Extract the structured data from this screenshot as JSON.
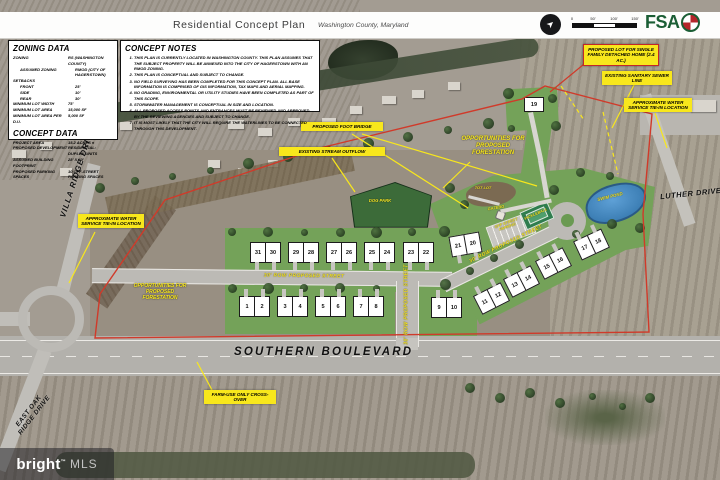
{
  "header": {
    "title": "Residential Concept Plan",
    "subtitle": "Washington County, Maryland",
    "logo_text": "FSA",
    "scale_ticks": [
      "0",
      "50'",
      "100'",
      "150'"
    ],
    "north_arrow_icon": "compass-north-arrow"
  },
  "panels": {
    "zoning": {
      "title": "ZONING DATA",
      "rows": [
        {
          "label": "ZONING",
          "value": "RS (WASHINGTON COUNTY)",
          "indent": 0
        },
        {
          "label": "ASSUMED ZONING",
          "value": "RMOD (CITY OF HAGERSTOWN)",
          "indent": 1
        },
        {
          "label": "SETBACKS",
          "value": "",
          "indent": 0
        },
        {
          "label": "FRONT",
          "value": "25'",
          "indent": 1
        },
        {
          "label": "SIDE",
          "value": "10'",
          "indent": 1
        },
        {
          "label": "REAR",
          "value": "30'",
          "indent": 1
        },
        {
          "label": "MINIMUM LOT WIDTH",
          "value": "75'",
          "indent": 0
        },
        {
          "label": "MINIMUM LOT AREA",
          "value": "15,000 SF",
          "indent": 0
        },
        {
          "label": "MINIMUM LOT AREA PER D.U.",
          "value": "5,000 SF",
          "indent": 0
        }
      ]
    },
    "concept": {
      "title": "CONCEPT DATA",
      "rows": [
        {
          "label": "PROJECT AREA",
          "value": "15.2 ACRES ±",
          "indent": 0
        },
        {
          "label": "PROPOSED DEVELOPMENT",
          "value": "RESIDENTIAL: DUPLEX UNITS",
          "indent": 0
        },
        {
          "label": "ASSUMED BUILDING FOOTPRINT",
          "value": "28' X 40'",
          "indent": 0
        },
        {
          "label": "PROPOSED PARKING SPACES",
          "value": "10 OFF-STREET PARKING SPACES",
          "indent": 0
        }
      ]
    },
    "notes": {
      "title": "CONCEPT NOTES",
      "items": [
        "THIS PLAN IS CURRENTLY LOCATED IN WASHINGTON COUNTY. THIS PLAN ASSUMES THAT THE SUBJECT PROPERTY WILL BE ANNEXED INTO THE CITY OF HAGERSTOWN WITH AN RMOD ZONING.",
        "THIS PLAN IS CONCEPTUAL AND SUBJECT TO CHANGE.",
        "NO FIELD SURVEYING HAS BEEN COMPLETED FOR THIS CONCEPT PLAN. ALL BASE INFORMATION IS COMPRISED OF GIS INFORMATION, TAX MAPS AND AERIAL MAPPING.",
        "NO GRADING, ENVIRONMENTAL OR UTILITY STUDIES HAVE BEEN COMPLETED AS PART OF THIS SCOPE.",
        "STORMWATER MANAGEMENT IS CONCEPTUAL IN SIZE AND LOCATION.",
        "ALL PROPOSED ACCESS POINTS AND ENTRANCES MUST BE REVIEWED AND APPROVED BY THE REVIEWING AGENCIES AND SUBJECT TO CHANGE.",
        "IT IS MOST LIKELY THAT THE CITY WILL REQUIRE THE WATERLINES TO BE CONNECTED THROUGH THIS DEVELOPMENT."
      ]
    }
  },
  "callouts": [
    {
      "text": "PROPOSED FOOT BRIDGE",
      "style": "box"
    },
    {
      "text": "EXISTING STREAM OUTFLOW",
      "style": "box"
    },
    {
      "text": "OPPORTUNITIES FOR PROPOSED FORESTATION",
      "style": "text"
    },
    {
      "text": "PROPOSED LOT FOR SINGLE FAMILY DETACHED HOME (2.4 AC.)",
      "style": "box-red"
    },
    {
      "text": "EXISTING SANITARY SEWER LINE",
      "style": "box"
    },
    {
      "text": "APPROXIMATE WATER SERVICE TIE-IN LOCATION",
      "style": "box"
    },
    {
      "text": "APPROXIMATE WATER SERVICE TIE-IN LOCATION",
      "style": "box"
    },
    {
      "text": "OPPORTUNITIES FOR PROPOSED FORESTATION",
      "style": "text"
    },
    {
      "text": "FARM-USE ONLY CROSS-OVER",
      "style": "box"
    }
  ],
  "amenity_labels": [
    "DOG PARK",
    "TOT LOT",
    "GAZEBO",
    "PICKLEBALL",
    "OFF STREET PARKING",
    "SWIM POND"
  ],
  "street_label": "30' ROW PROPOSED STREET",
  "road_labels": [
    "SOUTHERN BOULEVARD",
    "VILLA RIDGE DRIVE",
    "LUTHER DRIVE",
    "EAST OAK RIDGE DRIVE"
  ],
  "site": {
    "duplex_lots": [
      [
        "31",
        "30"
      ],
      [
        "29",
        "28"
      ],
      [
        "27",
        "26"
      ],
      [
        "25",
        "24"
      ],
      [
        "23",
        "22"
      ],
      [
        "1",
        "2"
      ],
      [
        "3",
        "4"
      ],
      [
        "5",
        "6"
      ],
      [
        "7",
        "8"
      ],
      [
        "9",
        "10"
      ],
      [
        "11",
        "12"
      ],
      [
        "13",
        "14"
      ],
      [
        "15",
        "16"
      ],
      [
        "17",
        "18"
      ],
      [
        "21",
        "20"
      ]
    ],
    "single_lot": "19"
  },
  "watermark": {
    "brand": "bright",
    "tm": "™",
    "suffix": "MLS"
  },
  "colors": {
    "callout_yellow": "#f8e71c",
    "boundary_red": "#d03a2a",
    "lawn_green": "#74a259",
    "dog_park_green": "#3c6b39",
    "pond_blue": "#3e85c0",
    "fsa_green": "#1b5e35",
    "street_gray": "#bcbab5"
  }
}
